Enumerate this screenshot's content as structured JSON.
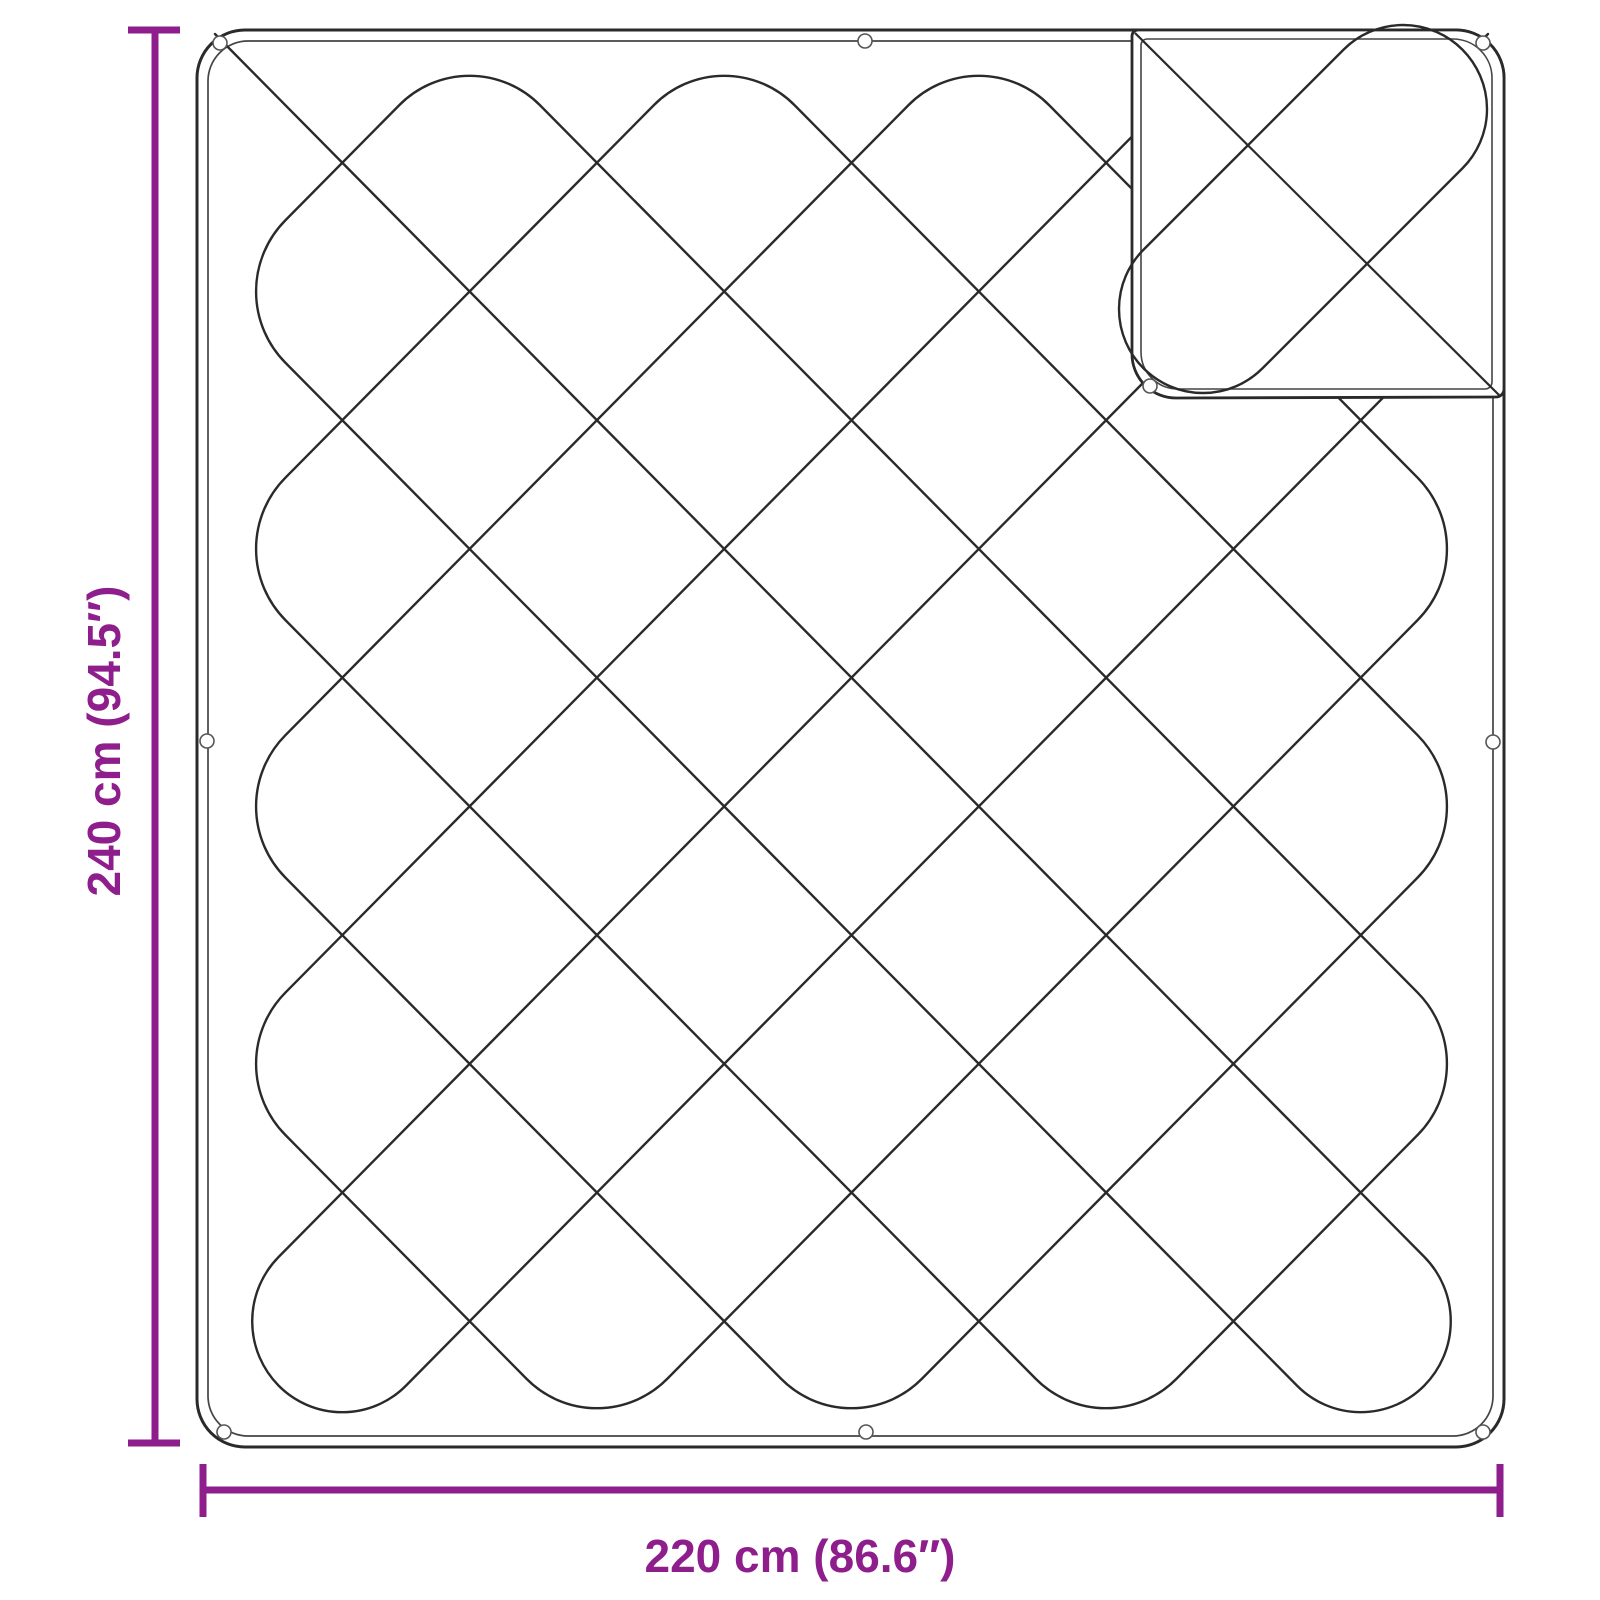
{
  "annotations": {
    "height_label": "240 cm (94.5″)",
    "width_label": "220 cm (86.6″)"
  },
  "figure": {
    "subject": "quilted blanket with folded corner",
    "eyelet_count": 9
  },
  "colors": {
    "accent": "#8e1e8c",
    "ink": "#2a2a2a",
    "ink_light": "#444444",
    "background": "#ffffff"
  }
}
